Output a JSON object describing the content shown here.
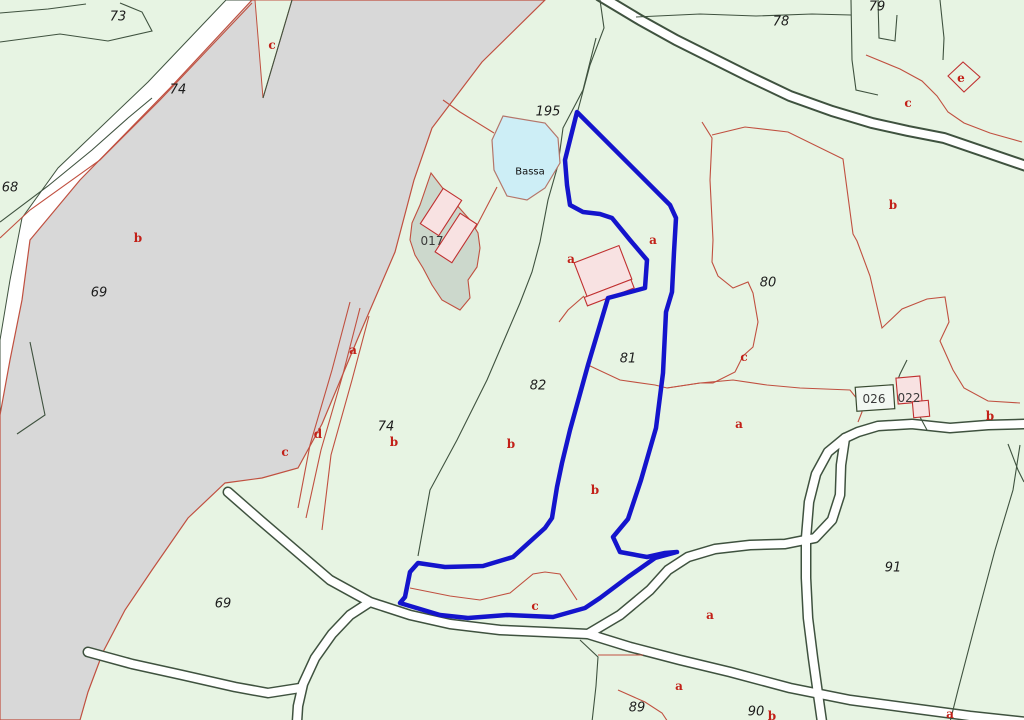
{
  "map": {
    "colors": {
      "background": "#e7f4e3",
      "highlight_blue": "#1414cc",
      "water_fill": "#cdeef6",
      "water_stroke": "#b4766b",
      "river_fill": "#d8d8d8",
      "road_fill": "#ffffff",
      "boundary": "#3f523f",
      "subparcel_red": "#c05040",
      "building_fill": "#f8e2e2",
      "building_stroke": "#c03030",
      "courtyard_fill": "#ccd8cc"
    },
    "highlighted_parcel": {
      "outline_points": "577,112 670,205 676,218 674,252 672,292 666,312 663,373 656,428 641,480 628,519 613,537 620,552 647,557 665,553 677,552 655,558 628,577 600,598 585,608 553,617 507,615 468,618 440,615 400,603 405,597 410,572 418,563 445,567 483,566 513,557 545,528 552,518 557,487 562,463 570,430 588,365 608,298 645,288 647,260 630,240 612,218 600,214 583,212 570,205 567,185 565,160"
    },
    "pond": {
      "name": "Bassa",
      "points": "503,116 545,123 558,138 560,163 545,188 527,200 507,196 494,170 492,140"
    },
    "labels": [
      {
        "text": "73",
        "x": 118,
        "y": 17,
        "kind": "number"
      },
      {
        "text": "74",
        "x": 178,
        "y": 90,
        "kind": "number",
        "color": "#6e352a"
      },
      {
        "text": "68",
        "x": 10,
        "y": 188,
        "kind": "number"
      },
      {
        "text": "69",
        "x": 99,
        "y": 293,
        "kind": "number"
      },
      {
        "text": "195",
        "x": 548,
        "y": 112,
        "kind": "number"
      },
      {
        "text": "78",
        "x": 781,
        "y": 22,
        "kind": "number"
      },
      {
        "text": "79",
        "x": 877,
        "y": 7,
        "kind": "number"
      },
      {
        "text": "80",
        "x": 768,
        "y": 283,
        "kind": "number"
      },
      {
        "text": "81",
        "x": 628,
        "y": 359,
        "kind": "number"
      },
      {
        "text": "82",
        "x": 538,
        "y": 386,
        "kind": "number"
      },
      {
        "text": "74",
        "x": 386,
        "y": 427,
        "kind": "number"
      },
      {
        "text": "69",
        "x": 223,
        "y": 604,
        "kind": "number",
        "color": "#6e352a"
      },
      {
        "text": "91",
        "x": 893,
        "y": 568,
        "kind": "number"
      },
      {
        "text": "89",
        "x": 637,
        "y": 708,
        "kind": "number"
      },
      {
        "text": "90",
        "x": 756,
        "y": 712,
        "kind": "number"
      },
      {
        "text": "c",
        "x": 272,
        "y": 45,
        "kind": "letter"
      },
      {
        "text": "b",
        "x": 138,
        "y": 238,
        "kind": "letter"
      },
      {
        "text": "e",
        "x": 961,
        "y": 78,
        "kind": "letter"
      },
      {
        "text": "c",
        "x": 908,
        "y": 103,
        "kind": "letter"
      },
      {
        "text": "b",
        "x": 893,
        "y": 205,
        "kind": "letter"
      },
      {
        "text": "a",
        "x": 653,
        "y": 240,
        "kind": "letter"
      },
      {
        "text": "a",
        "x": 571,
        "y": 259,
        "kind": "letter"
      },
      {
        "text": "a",
        "x": 353,
        "y": 350,
        "kind": "letter"
      },
      {
        "text": "d",
        "x": 318,
        "y": 434,
        "kind": "letter"
      },
      {
        "text": "c",
        "x": 285,
        "y": 452,
        "kind": "letter"
      },
      {
        "text": "b",
        "x": 394,
        "y": 442,
        "kind": "letter"
      },
      {
        "text": "b",
        "x": 511,
        "y": 444,
        "kind": "letter"
      },
      {
        "text": "b",
        "x": 595,
        "y": 490,
        "kind": "letter"
      },
      {
        "text": "c",
        "x": 744,
        "y": 357,
        "kind": "letter"
      },
      {
        "text": "a",
        "x": 739,
        "y": 424,
        "kind": "letter"
      },
      {
        "text": "c",
        "x": 535,
        "y": 606,
        "kind": "letter"
      },
      {
        "text": "a",
        "x": 710,
        "y": 615,
        "kind": "letter"
      },
      {
        "text": "a",
        "x": 679,
        "y": 686,
        "kind": "letter"
      },
      {
        "text": "b",
        "x": 990,
        "y": 416,
        "kind": "letter"
      },
      {
        "text": "b",
        "x": 772,
        "y": 716,
        "kind": "letter"
      },
      {
        "text": "a",
        "x": 950,
        "y": 714,
        "kind": "letter"
      },
      {
        "text": "017",
        "x": 432,
        "y": 241,
        "kind": "building",
        "color": "#3a3a3a"
      },
      {
        "text": "026",
        "x": 874,
        "y": 399,
        "kind": "building",
        "color": "#1a1a1a"
      },
      {
        "text": "022",
        "x": 909,
        "y": 398,
        "kind": "building",
        "color": "#7a3326"
      },
      {
        "text": "Bassa",
        "x": 530,
        "y": 172,
        "kind": "water"
      }
    ]
  }
}
